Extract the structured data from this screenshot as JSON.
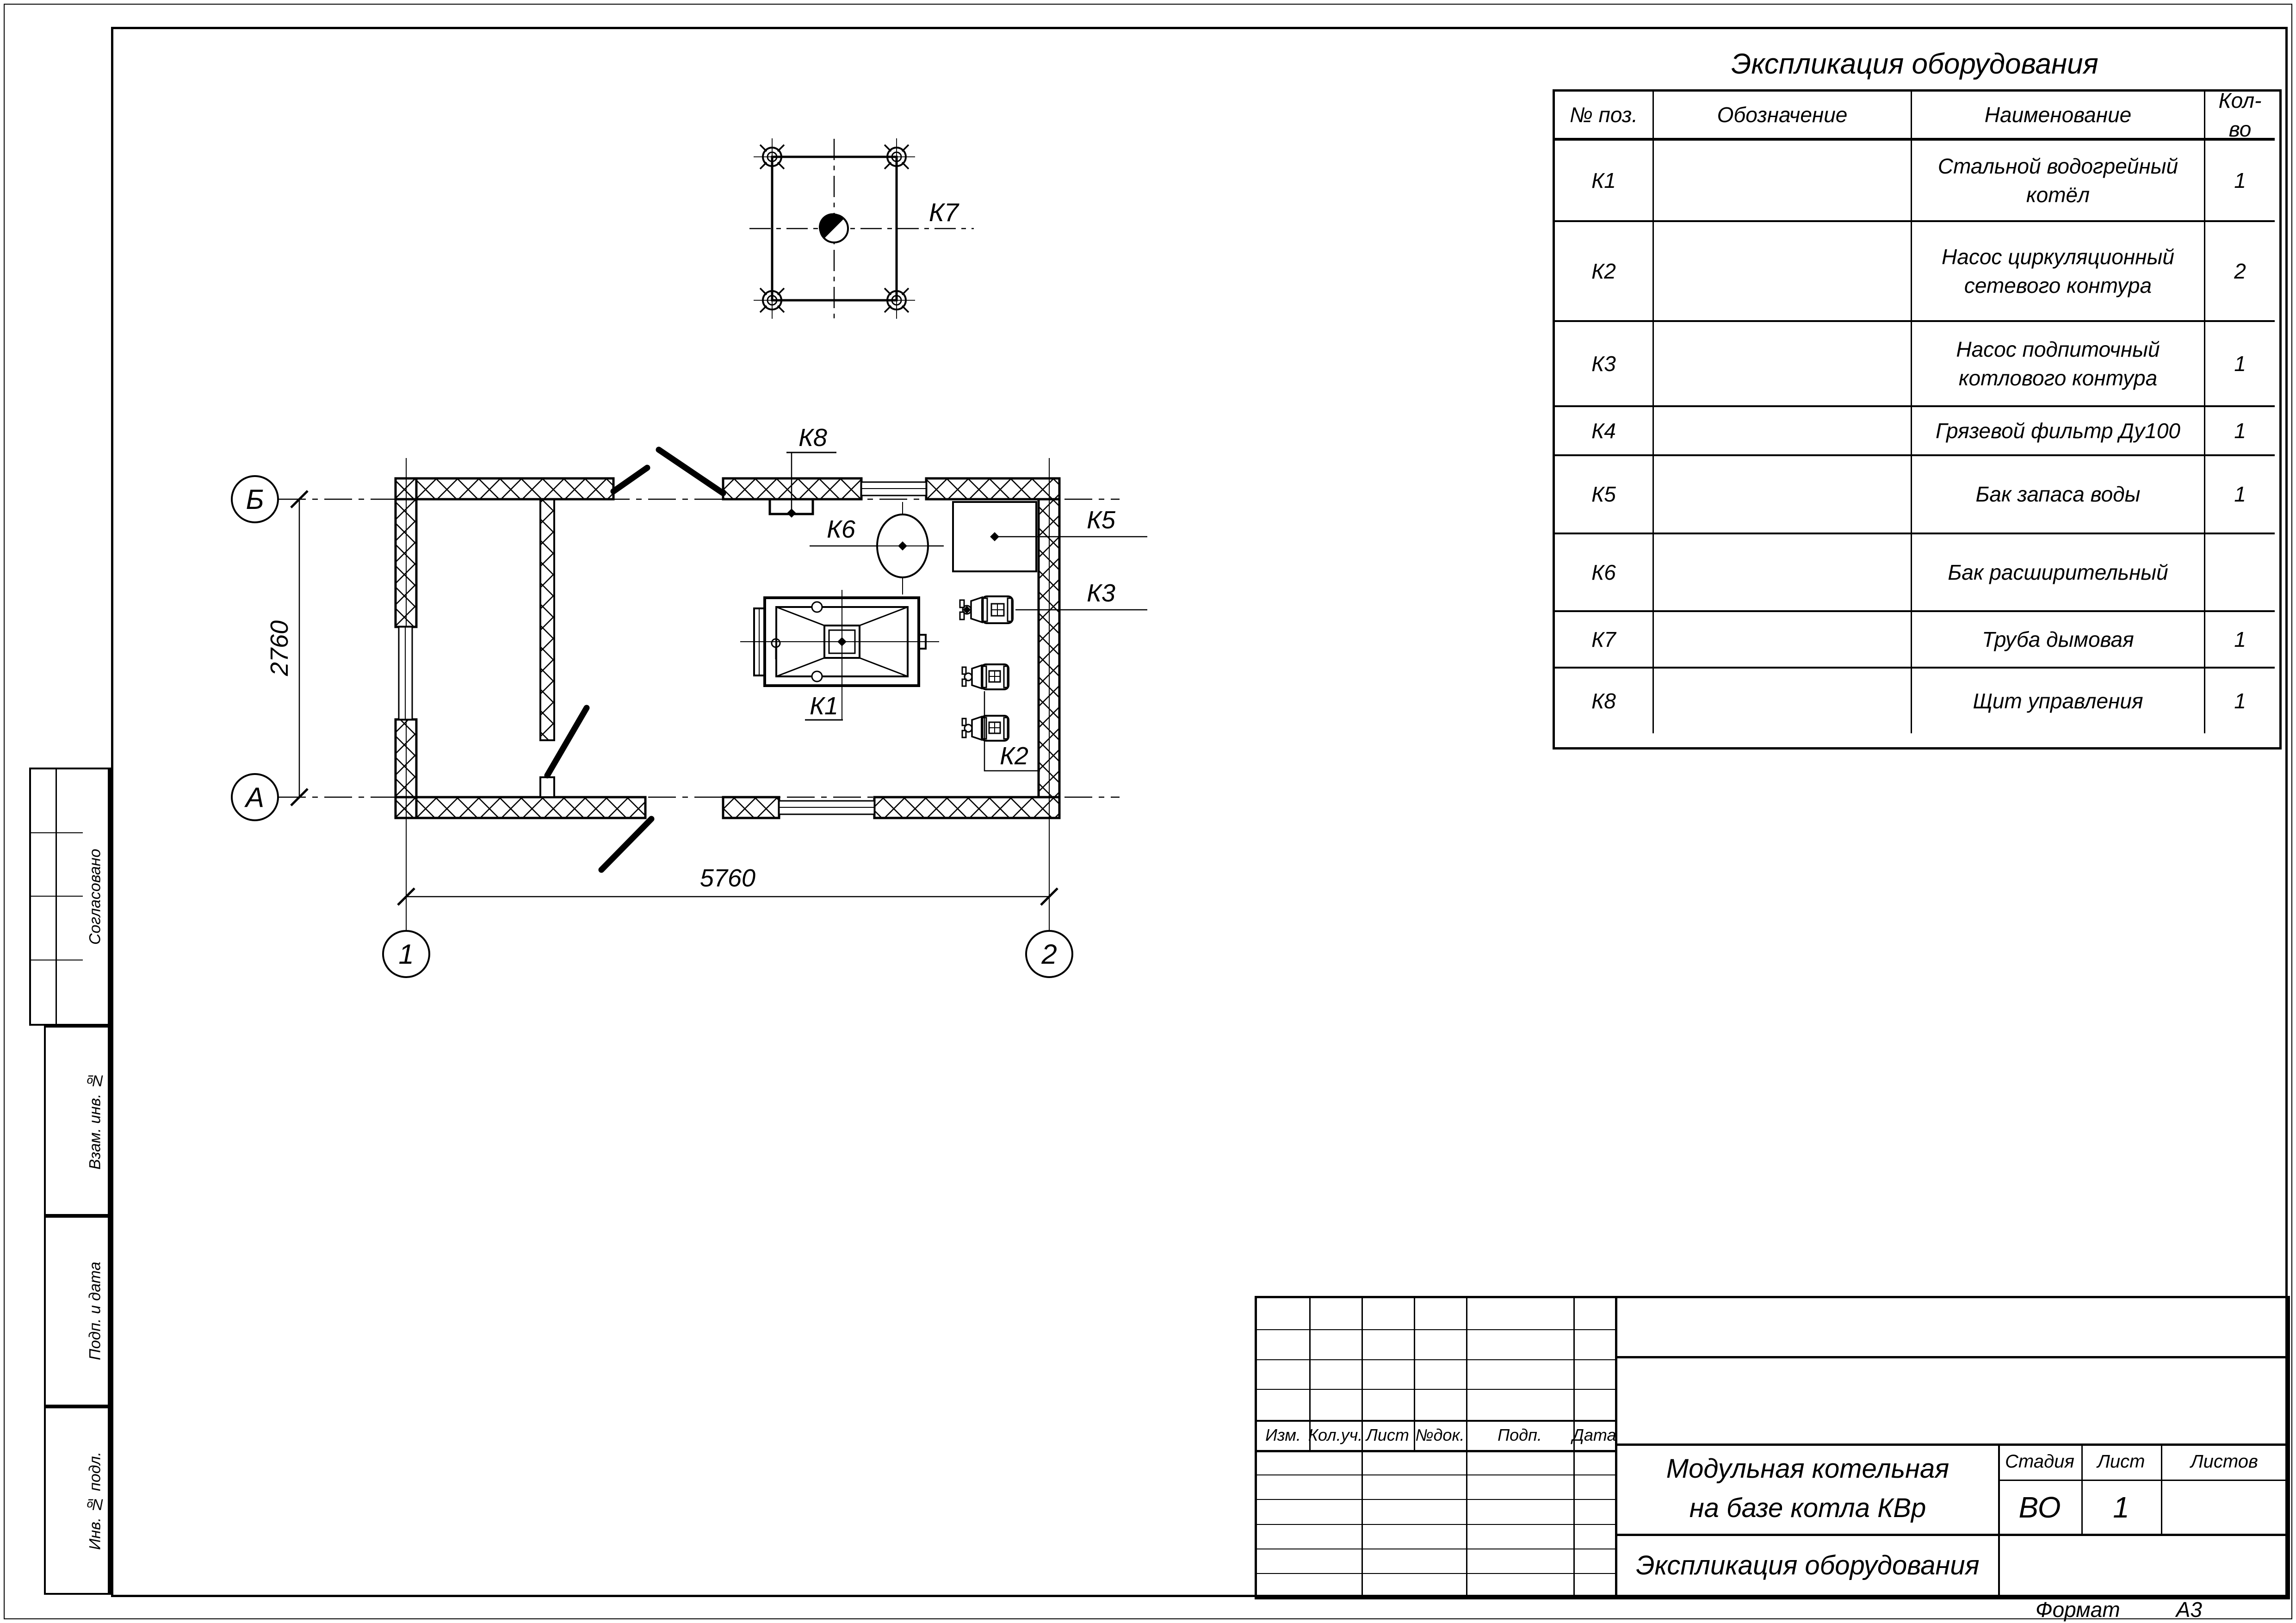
{
  "table": {
    "title": "Экспликация оборудования",
    "headers": {
      "pos": "№ поз.",
      "designation": "Обозначение",
      "name": "Наименование",
      "qty": "Кол-во"
    },
    "rows": [
      {
        "pos": "К1",
        "designation": "",
        "name": "Стальной водогрейный котёл",
        "qty": "1"
      },
      {
        "pos": "К2",
        "designation": "",
        "name": "Насос циркуляционный сетевого контура",
        "qty": "2"
      },
      {
        "pos": "К3",
        "designation": "",
        "name": "Насос подпиточный котлового контура",
        "qty": "1"
      },
      {
        "pos": "К4",
        "designation": "",
        "name": "Грязевой фильтр Ду100",
        "qty": "1"
      },
      {
        "pos": "К5",
        "designation": "",
        "name": "Бак запаса воды",
        "qty": "1"
      },
      {
        "pos": "К6",
        "designation": "",
        "name": "Бак расширительный",
        "qty": ""
      },
      {
        "pos": "К7",
        "designation": "",
        "name": "Труба дымовая",
        "qty": "1"
      },
      {
        "pos": "К8",
        "designation": "",
        "name": "Щит управления",
        "qty": "1"
      }
    ]
  },
  "plan": {
    "labels": {
      "k1": "К1",
      "k2": "К2",
      "k3": "К3",
      "k5": "К5",
      "k6": "К6",
      "k7": "К7",
      "k8": "К8"
    },
    "axes": {
      "b": "Б",
      "a": "А",
      "one": "1",
      "two": "2"
    },
    "dims": {
      "width": "5760",
      "height": "2760"
    }
  },
  "title_block": {
    "doc_title_line1": "Модульная котельная",
    "doc_title_line2": "на базе котла КВр",
    "doc_subtitle": "Экспликация оборудования",
    "stage_label": "Стадия",
    "sheet_label": "Лист",
    "sheets_label": "Листов",
    "stage": "ВО",
    "sheet": "1",
    "sheets": "",
    "rev_headers": [
      "Изм.",
      "Кол.уч.",
      "Лист",
      "№док.",
      "Подп.",
      "Дата"
    ]
  },
  "side_strip": {
    "approved": "Согласовано",
    "replace_inv": "Взам. инв. №",
    "sign_date": "Подп. и дата",
    "inv_orig": "Инв. № подл."
  },
  "footer": {
    "format_label": "Формат",
    "format_value": "А3"
  }
}
